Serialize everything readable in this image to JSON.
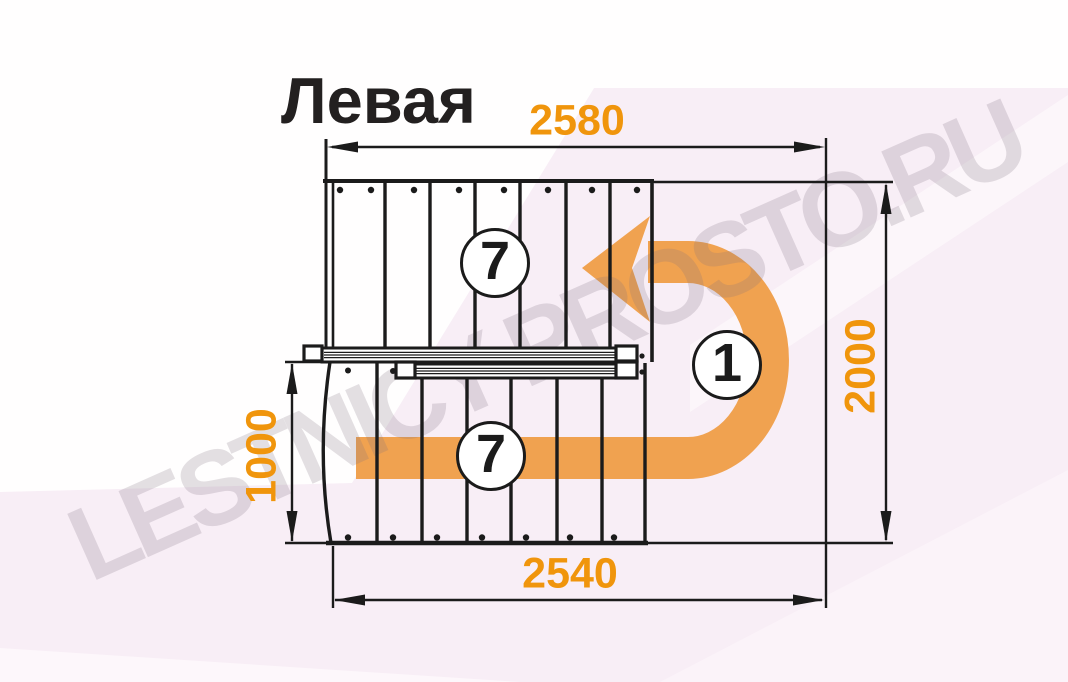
{
  "page": {
    "title": "Левая",
    "watermark": "LESTNICY-PROSTO.RU"
  },
  "plan": {
    "dimensions_mm": {
      "top": "2580",
      "right": "2000",
      "left": "1000",
      "bottom": "2540"
    },
    "flights": {
      "upper_steps": "7",
      "lower_steps": "7",
      "landing_count": "1"
    }
  },
  "colors": {
    "dimension_text": "#f0950c",
    "arrow_orange": "#f0a250",
    "drawing_line": "#1b1b1b",
    "background_tint": "#f8eef6",
    "watermark_gray": "#e3e1e4"
  }
}
